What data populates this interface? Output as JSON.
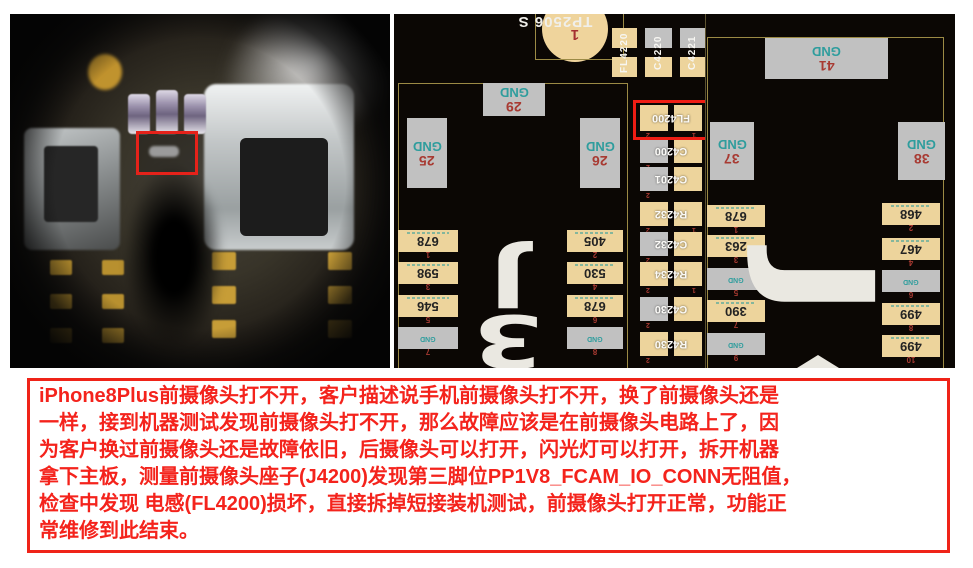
{
  "colors": {
    "pad_tan": "#edd49c",
    "pad_gray": "#c1c1c1",
    "net_teal": "#2f9d9d",
    "pin_red": "#a83a32",
    "silkscreen_white": "#eae8e1",
    "board_black": "#0b0704",
    "outline_olive": "#9b8a45",
    "highlight_red": "#ee1d14",
    "note_red": "#f4231c"
  },
  "boardview": {
    "pin_marks": {
      "left": "2",
      "right": "1"
    },
    "testpoint": {
      "label": "TP2506 S",
      "pin": "1"
    },
    "top_discretes": [
      {
        "ref": "FL4220"
      },
      {
        "ref": "C4220"
      },
      {
        "ref": "C4221"
      }
    ],
    "connector_mid": {
      "designator_glyphs": [
        "J",
        "3"
      ],
      "gnd_pads": {
        "top": {
          "net": "GND",
          "pin": "29"
        },
        "left": {
          "net": "GND",
          "pin": "25"
        },
        "right": {
          "net": "GND",
          "pin": "26"
        }
      },
      "left_pads": [
        {
          "value": "678",
          "pin": "1"
        },
        {
          "value": "598",
          "pin": "3"
        },
        {
          "value": "546",
          "pin": "5"
        },
        {
          "value": "GND",
          "pin": "7"
        }
      ],
      "right_pads": [
        {
          "value": "405",
          "pin": "2"
        },
        {
          "value": "530",
          "pin": "4"
        },
        {
          "value": "678",
          "pin": "6"
        },
        {
          "value": "GND",
          "pin": "8"
        }
      ]
    },
    "component_column": [
      {
        "ref": "FL4200"
      },
      {
        "ref": "C4200"
      },
      {
        "ref": "C4201"
      },
      {
        "ref": "R4232"
      },
      {
        "ref": "C4232"
      },
      {
        "ref": "R4234"
      },
      {
        "ref": "C4230"
      },
      {
        "ref": "R4230"
      }
    ],
    "connector_right": {
      "designator_glyph": "J",
      "gnd_pads": {
        "top": {
          "net": "GND",
          "pin": "41"
        },
        "left": {
          "net": "GND",
          "pin": "37"
        },
        "right": {
          "net": "GND",
          "pin": "38"
        }
      },
      "left_pads": [
        {
          "value": "678",
          "pin": "1"
        },
        {
          "value": "263",
          "pin": "3"
        },
        {
          "value": "GND",
          "pin": "5"
        },
        {
          "value": "390",
          "pin": "7"
        },
        {
          "value": "GND",
          "pin": "9"
        }
      ],
      "right_pads": [
        {
          "value": "468",
          "pin": "2"
        },
        {
          "value": "467",
          "pin": "4"
        },
        {
          "value": "GND",
          "pin": "6"
        },
        {
          "value": "499",
          "pin": "8"
        },
        {
          "value": "499",
          "pin": "10"
        }
      ]
    }
  },
  "note": {
    "lines": [
      "iPhone8Plus前摄像头打不开，客户描述说手机前摄像头打不开，换了前摄像头还是",
      "一样，接到机器测试发现前摄像头打不开，那么故障应该是在前摄像头电路上了，因",
      "为客户换过前摄像头还是故障依旧，后摄像头可以打开，闪光灯可以打开，拆开机器",
      "拿下主板，测量前摄像头座子(J4200)发现第三脚位PP1V8_FCAM_IO_CONN无阻值，",
      "检查中发现 电感(FL4200)损坏，直接拆掉短接装机测试，前摄像头打开正常，功能正",
      "常维修到此结束。"
    ]
  }
}
